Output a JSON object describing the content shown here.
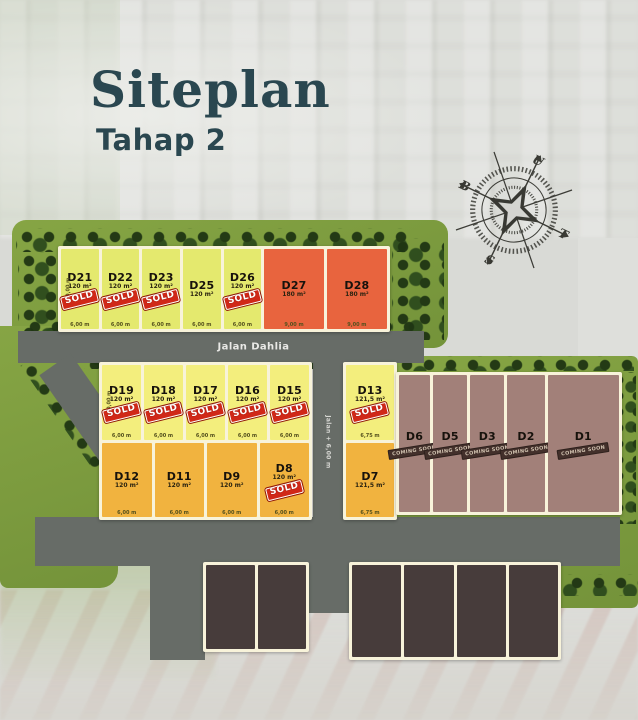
{
  "header": {
    "title": "Siteplan",
    "subtitle": "Tahap 2"
  },
  "labels": {
    "sold": "SOLD",
    "main_road": "Jalan Dahlia",
    "side_road": "Jalan + 6,00 m"
  },
  "compass": {
    "points": [
      "U",
      "T",
      "S",
      "B"
    ]
  },
  "palette": {
    "lime": "#e4e96e",
    "orange": "#e8643e",
    "yellow": "#f3ee7d",
    "amber": "#f1b33f",
    "mauve": "#a28079",
    "dark_block": "#473c3b",
    "road": "#676c67",
    "green": "#7d9e3d",
    "cream_border": "#f8f3da",
    "sold_red": "#d02818",
    "title_text": "#2a4750"
  },
  "rows": {
    "top": {
      "lots": [
        {
          "id": "D21",
          "area": "120 m²",
          "sold": true,
          "color": "lime",
          "flex": 1,
          "width_label": "6,00 m",
          "side_label": "20,00 m"
        },
        {
          "id": "D22",
          "area": "120 m²",
          "sold": true,
          "color": "lime",
          "flex": 1,
          "width_label": "6,00 m"
        },
        {
          "id": "D23",
          "area": "120 m²",
          "sold": true,
          "color": "lime",
          "flex": 1,
          "width_label": "6,00 m"
        },
        {
          "id": "D25",
          "area": "120 m²",
          "sold": false,
          "color": "lime",
          "flex": 1,
          "width_label": "6,00 m"
        },
        {
          "id": "D26",
          "area": "120 m²",
          "sold": true,
          "color": "lime",
          "flex": 1,
          "width_label": "6,00 m"
        },
        {
          "id": "D27",
          "area": "180 m²",
          "sold": false,
          "color": "orange",
          "flex": 1.58,
          "width_label": "9,00 m"
        },
        {
          "id": "D28",
          "area": "180 m²",
          "sold": false,
          "color": "orange",
          "flex": 1.6,
          "width_label": "9,00 m"
        }
      ]
    },
    "mid1": {
      "lots": [
        {
          "id": "D19",
          "area": "120 m²",
          "sold": true,
          "color": "yellow",
          "flex": 1,
          "width_label": "6,00 m",
          "side_label": "20,00 m"
        },
        {
          "id": "D18",
          "area": "120 m²",
          "sold": true,
          "color": "yellow",
          "flex": 1,
          "width_label": "6,00 m"
        },
        {
          "id": "D17",
          "area": "120 m²",
          "sold": true,
          "color": "yellow",
          "flex": 1,
          "width_label": "6,00 m"
        },
        {
          "id": "D16",
          "area": "120 m²",
          "sold": true,
          "color": "yellow",
          "flex": 1,
          "width_label": "6,00 m"
        },
        {
          "id": "D15",
          "area": "120 m²",
          "sold": true,
          "color": "yellow",
          "flex": 1,
          "width_label": "6,00 m"
        }
      ]
    },
    "mid2": {
      "lots": [
        {
          "id": "D12",
          "area": "120 m²",
          "sold": false,
          "color": "amber",
          "flex": 1,
          "width_label": "6,00 m"
        },
        {
          "id": "D11",
          "area": "120 m²",
          "sold": false,
          "color": "amber",
          "flex": 1,
          "width_label": "6,00 m"
        },
        {
          "id": "D9",
          "area": "120 m²",
          "sold": false,
          "color": "amber",
          "flex": 1,
          "width_label": "6,00 m"
        },
        {
          "id": "D8",
          "area": "120 m²",
          "sold": true,
          "color": "amber",
          "flex": 1,
          "width_label": "6,00 m"
        }
      ]
    },
    "col": {
      "lots": [
        {
          "id": "D13",
          "area": "121,5 m²",
          "sold": true,
          "color": "yellow",
          "flex": 1,
          "width_label": "6,75 m"
        },
        {
          "id": "D7",
          "area": "121,5 m²",
          "sold": false,
          "color": "amber",
          "flex": 1,
          "width_label": "6,75 m"
        }
      ]
    },
    "right": {
      "lots": [
        {
          "id": "D6",
          "status": "COMING SOON",
          "color": "mauve",
          "flex": 1
        },
        {
          "id": "D5",
          "status": "COMING SOON",
          "color": "mauve",
          "flex": 1.1
        },
        {
          "id": "D3",
          "status": "COMING SOON",
          "color": "mauve",
          "flex": 1.1
        },
        {
          "id": "D2",
          "status": "COMING SOON",
          "color": "mauve",
          "flex": 1.2
        },
        {
          "id": "D1",
          "status": "COMING SOON",
          "color": "mauve",
          "flex": 2.3
        }
      ]
    },
    "bottom_a": {
      "lots": [
        {
          "color": "dark"
        },
        {
          "color": "dark"
        }
      ]
    },
    "bottom_b": {
      "lots": [
        {
          "color": "dark"
        },
        {
          "color": "dark"
        },
        {
          "color": "dark"
        },
        {
          "color": "dark"
        }
      ]
    }
  }
}
